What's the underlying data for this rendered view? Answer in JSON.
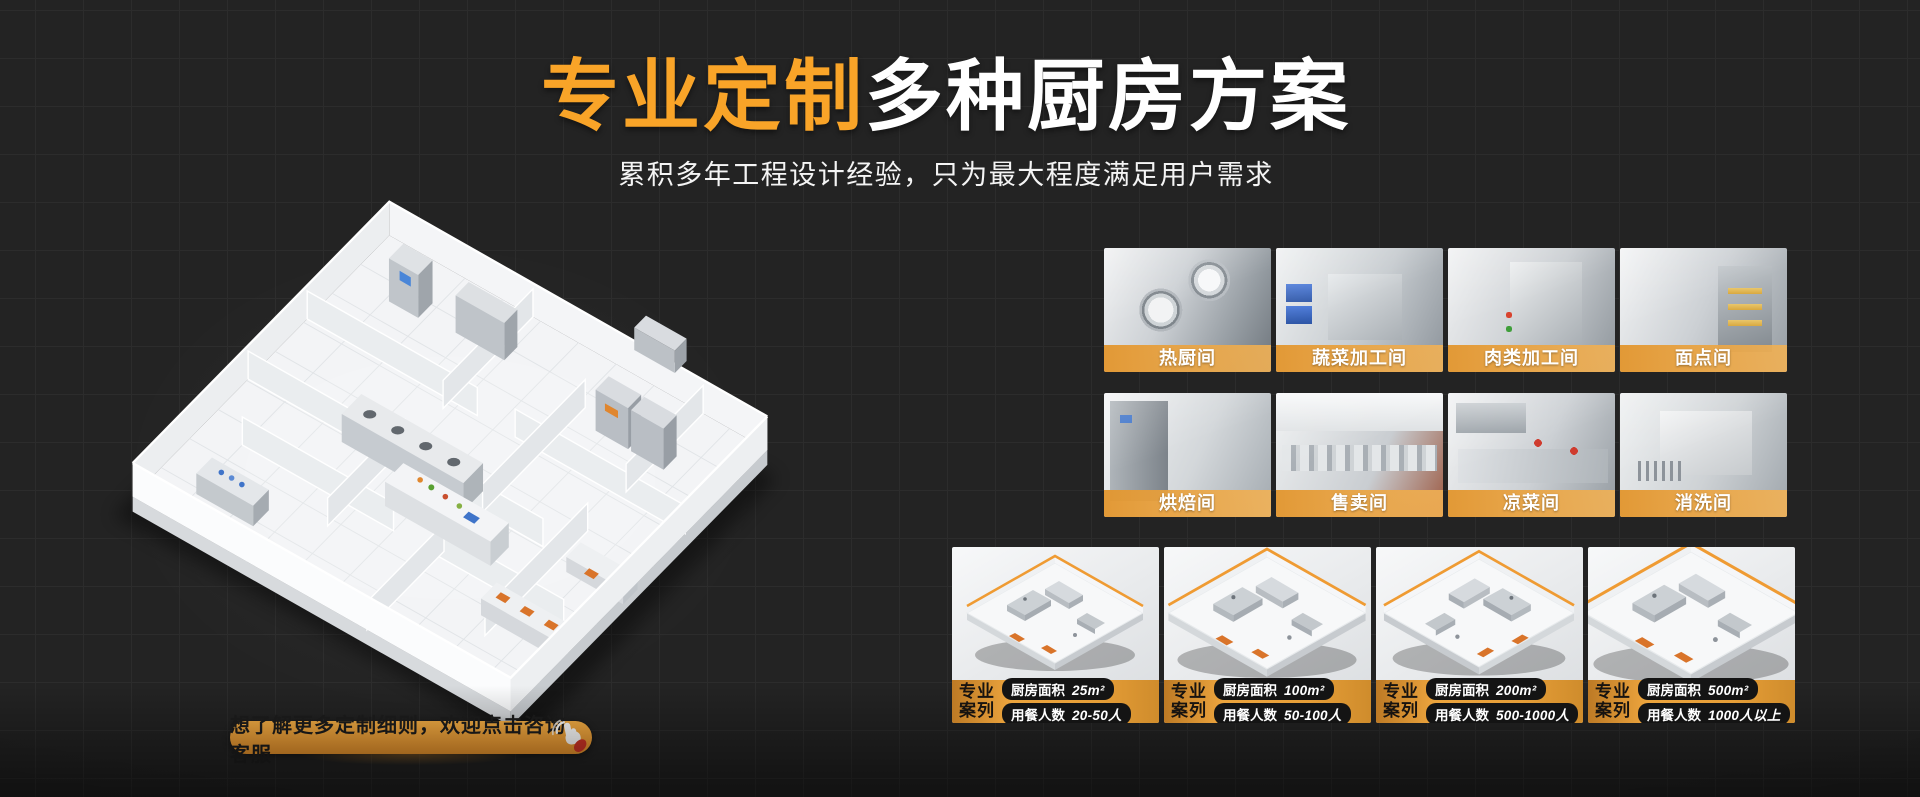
{
  "colors": {
    "background": "#232323",
    "grid_line": "#2C2C2C",
    "accent_orange": "#F9A428",
    "band_orange": "#E89E37",
    "cta_text": "#1D1D1D"
  },
  "hero": {
    "title_highlight": "专业定制",
    "title_rest": "多种厨房方案",
    "subtitle": "累积多年工程设计经验，只为最大程度满足用户需求"
  },
  "rooms": {
    "items": [
      {
        "label": "热厨间"
      },
      {
        "label": "蔬菜加工间"
      },
      {
        "label": "肉类加工间"
      },
      {
        "label": "面点间"
      },
      {
        "label": "烘焙间"
      },
      {
        "label": "售卖间"
      },
      {
        "label": "凉菜间"
      },
      {
        "label": "消洗间"
      }
    ]
  },
  "cases": {
    "badge_line1": "专业",
    "badge_line2": "案列",
    "items": [
      {
        "area_label": "厨房面积",
        "area_value": "25m²",
        "diners_label": "用餐人数",
        "diners_value": "20-50人"
      },
      {
        "area_label": "厨房面积",
        "area_value": "100m²",
        "diners_label": "用餐人数",
        "diners_value": "50-100人"
      },
      {
        "area_label": "厨房面积",
        "area_value": "200m²",
        "diners_label": "用餐人数",
        "diners_value": "500-1000人"
      },
      {
        "area_label": "厨房面积",
        "area_value": "500m²",
        "diners_label": "用餐人数",
        "diners_value": "1000人以上"
      }
    ]
  },
  "cta": {
    "label": "想了解更多定制细则，欢迎点击咨询客服",
    "icon": "click-hand-icon"
  }
}
